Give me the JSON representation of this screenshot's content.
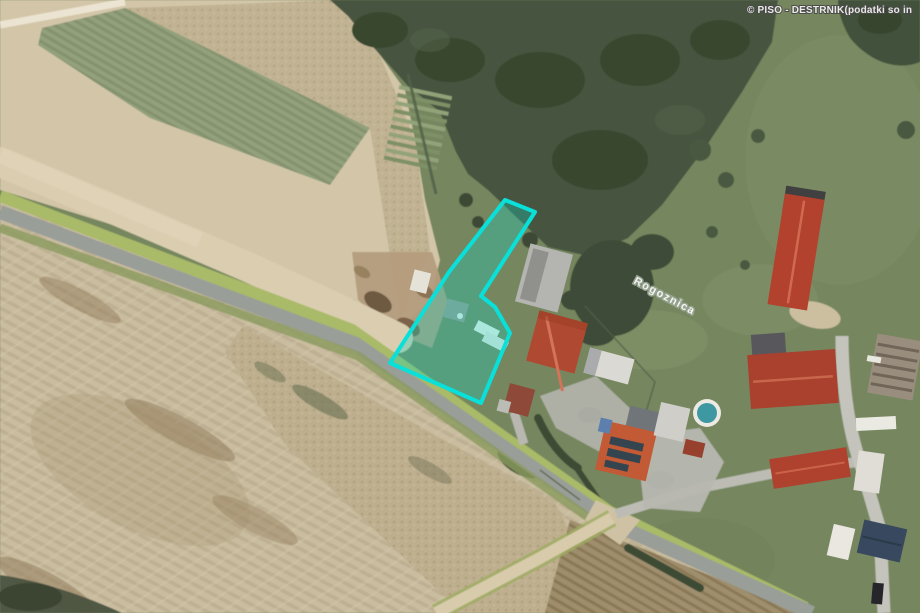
{
  "app": {
    "watermark": "© PISO - DESTRNIK(podatki so in"
  },
  "map": {
    "street_label": "Rogoznica",
    "parcel": {
      "points": "505,200 535,212 481,296 495,307 510,333 481,403 390,363 449,272",
      "stroke": "#0ae0da",
      "fill": "rgba(10,215,200,0.30)"
    }
  }
}
